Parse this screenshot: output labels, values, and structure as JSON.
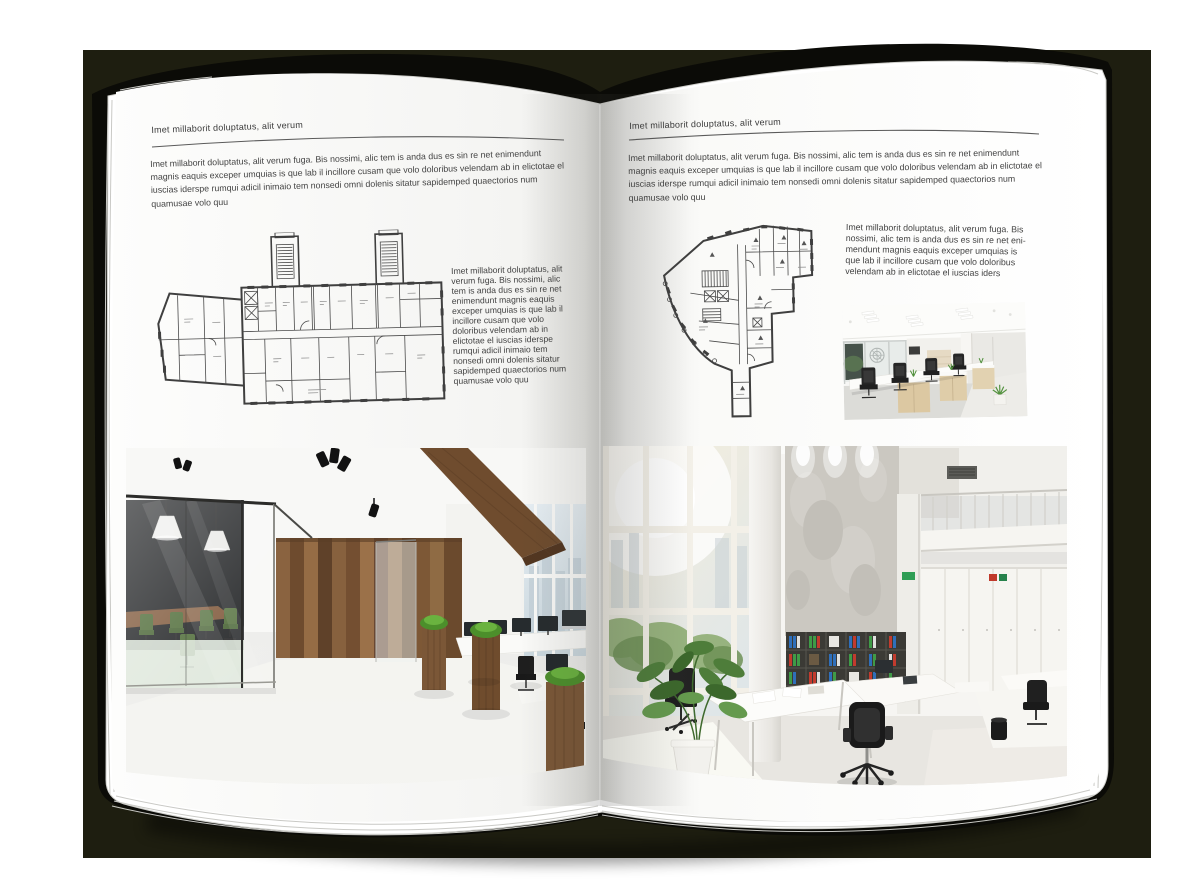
{
  "backdrop": {
    "color": "#1e1e10"
  },
  "book": {
    "page_color": "#ffffff",
    "cover_color": "#0b0b07"
  },
  "left_page": {
    "header": "Imet millaborit doluptatus, alit verum",
    "body": "Imet millaborit doluptatus, alit verum fuga. Bis nossimi, alic tem is anda dus es sin re net enimendunt magnis eaquis exceper umquias is que lab il incillore cusam que volo doloribus velendam ab in elictotae el iuscias iderspe rumqui adicil inimaio tem nonsedi omni dolenis sitatur sapidemped quaectorios num quamusae volo quu",
    "side_text": "Imet millaborit doluptatus, alit verum fuga. Bis nossimi, alic tem is anda dus es sin re net enimendunt magnis eaquis exceper umquias is que lab il incillore cusam que volo doloribus velendam ab in elictotae el iuscias iderspe rumqui adicil inimaio tem nonsedi omni dolenis sitatur sapidemped quaectorios num quamusae volo quu"
  },
  "right_page": {
    "header": "Imet millaborit doluptatus, alit verum",
    "body": "Imet millaborit doluptatus, alit verum fuga. Bis nossimi, alic tem is anda dus es sin re net enimendunt magnis eaquis exceper umquias is que lab il incillore cusam que volo doloribus velendam ab in elictotae el iuscias iderspe rumqui adicil inimaio tem nonsedi omni dolenis sitatur sapidemped quaectorios num quamusae volo quu",
    "side_text": "Imet millaborit doluptatus, alit verum fuga. Bis nossimi, alic tem is anda dus es sin re net eni-mendunt magnis eaquis exceper umquias is que lab il incillore cusam que volo doloribus velendam ab in elictotae el iuscias iders"
  }
}
